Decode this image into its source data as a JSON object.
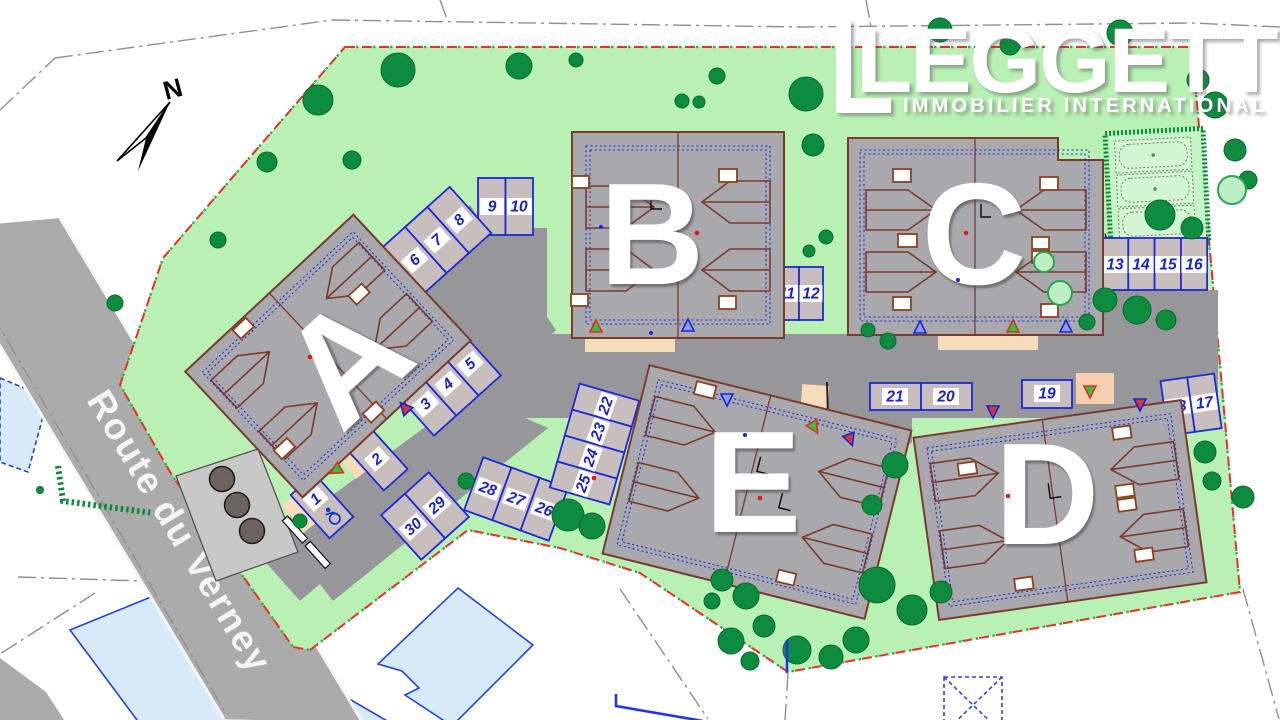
{
  "logo": {
    "brand": "LEGGETT",
    "tagline": "IMMOBILIER INTERNATIONAL"
  },
  "compass": {
    "north_label": "N"
  },
  "road": {
    "name": "Route du Verney"
  },
  "buildings": [
    {
      "label": "A"
    },
    {
      "label": "B"
    },
    {
      "label": "C"
    },
    {
      "label": "D"
    },
    {
      "label": "E"
    }
  ],
  "parking": {
    "spaces": [
      "1",
      "2",
      "3",
      "4",
      "5",
      "6",
      "7",
      "8",
      "9",
      "10",
      "11",
      "12",
      "13",
      "14",
      "15",
      "16",
      "17",
      "18",
      "19",
      "20",
      "21",
      "22",
      "23",
      "24",
      "25",
      "26",
      "27",
      "28",
      "29",
      "30"
    ]
  },
  "amenities": {
    "boules_courts": 3,
    "bin_store": 3
  },
  "colors": {
    "lawn": "#b9f0b4",
    "route_road": "#ababab",
    "internal_road": "#97979b",
    "building": "#a8a8ad",
    "parking_fill": "#c9bebe",
    "parking_border": "#1d2ad6",
    "roof_line": "#7a3b2f",
    "boundary_red": "#e53126",
    "boundary_green": "#2ab04f",
    "tree_green": "#0d8c3f",
    "neighbor_fill": "#d8e9fa",
    "neighbor_border": "#2244e0",
    "walkway_beige": "#f6dcbb",
    "number_blue": "#1b23cc"
  }
}
